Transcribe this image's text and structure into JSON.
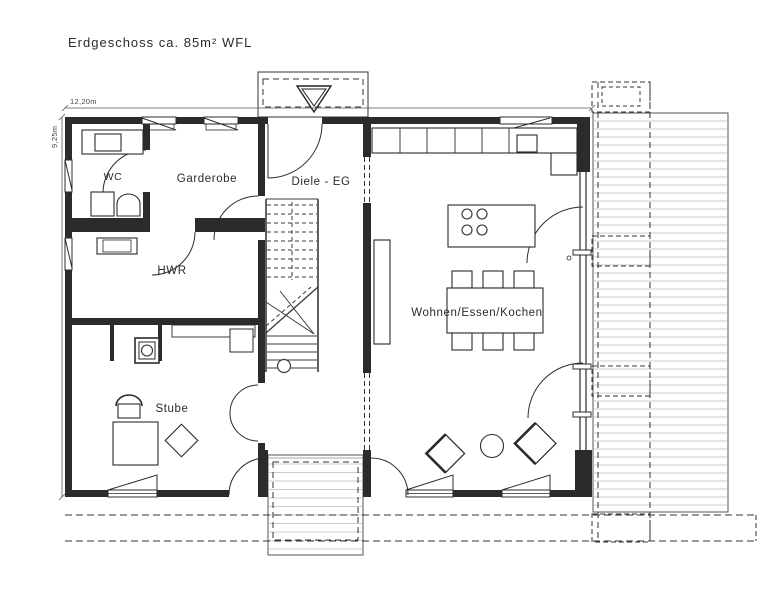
{
  "title": "Erdgeschoss ca. 85m² WFL",
  "dimensions": {
    "width_label": "12,20m",
    "height_label": "9,25m"
  },
  "rooms": {
    "wc": "WC",
    "garderobe": "Garderobe",
    "diele": "Diele - EG",
    "hwr": "HWR",
    "stube": "Stube",
    "wohnen": "Wohnen/Essen/Kochen"
  },
  "colors": {
    "line": "#2b2b2b",
    "deck_plank": "#cccccc",
    "background": "#ffffff"
  }
}
